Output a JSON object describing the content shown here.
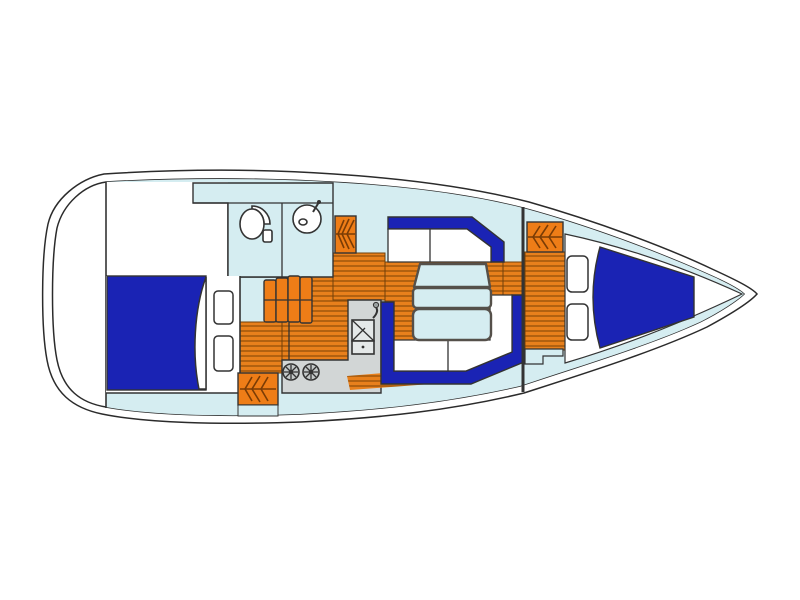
{
  "diagram": {
    "type": "boat-floor-plan",
    "description": "Top-down interior layout plan of a sailing yacht, bow pointing right",
    "regions": [
      {
        "id": "aft-utility-area",
        "label": "aft utility / cockpit locker area"
      },
      {
        "id": "aft-cabin",
        "label": "aft double berth cabin"
      },
      {
        "id": "head-compartment",
        "label": "head with toilet and wash basin"
      },
      {
        "id": "companionway-steps",
        "label": "companionway steps"
      },
      {
        "id": "galley",
        "label": "galley with sink and two-burner stove"
      },
      {
        "id": "salon",
        "label": "salon with two settees and table"
      },
      {
        "id": "forward-cabin",
        "label": "forward V-berth cabin"
      },
      {
        "id": "hanging-lockers",
        "label": "hanging lockers (hatched)"
      },
      {
        "id": "cabin-sole",
        "label": "wood plank cabin sole"
      }
    ],
    "icons": [
      "toilet-icon",
      "washbasin-icon",
      "galley-sink-icon",
      "stove-burner-icon",
      "hanging-clothes-icon"
    ]
  },
  "colors": {
    "hull_outline": "#2b2b2b",
    "furniture_outline": "#333333",
    "interior_cyan": "#d5edf1",
    "berth_blue": "#1a23b4",
    "wood_orange": "#e8801c",
    "wood_stripe": "#a4590c",
    "wood_seam": "#70400a",
    "locker_orange": "#ee7d17",
    "counter_gray": "#d2d6d6",
    "table_border": "#55504a"
  }
}
